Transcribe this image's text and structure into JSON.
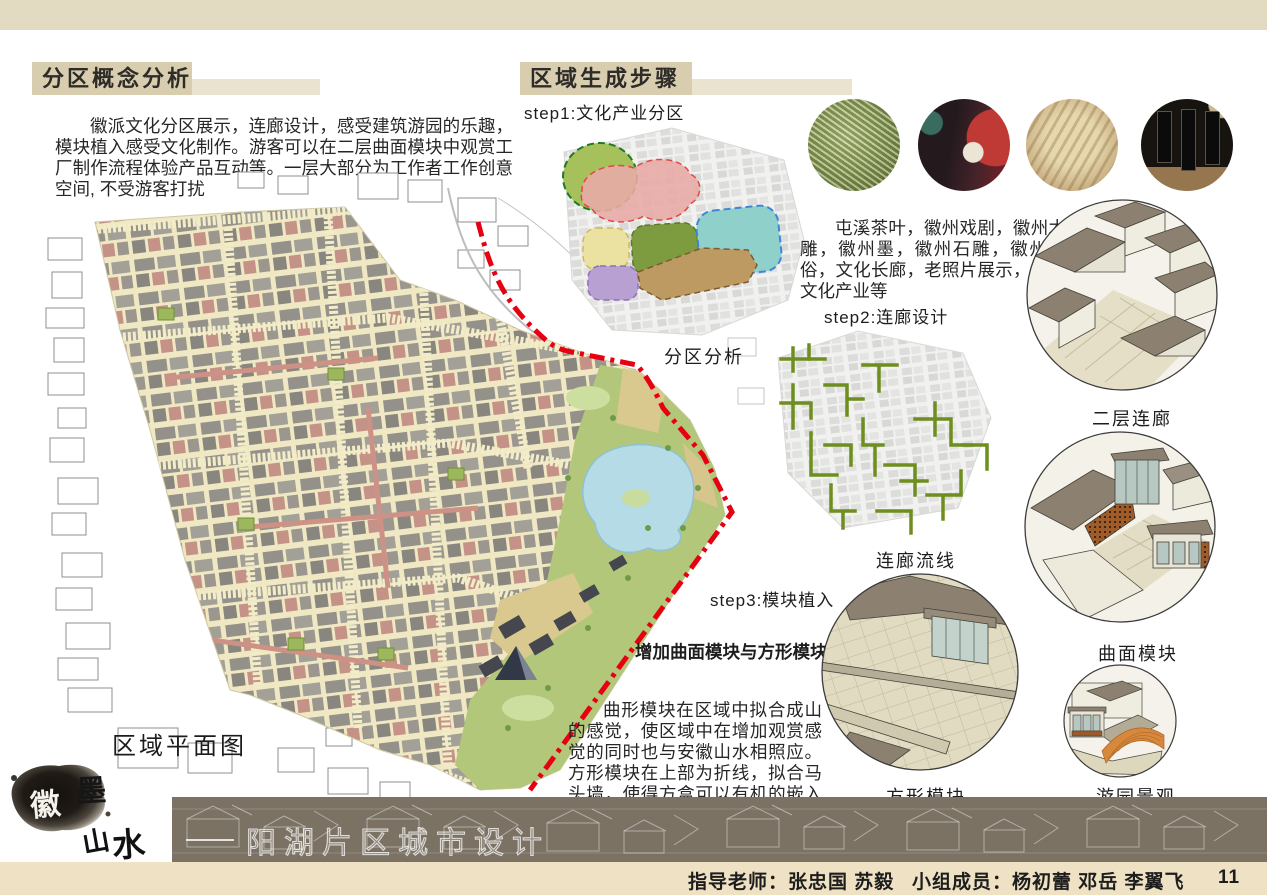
{
  "left_section": {
    "title": "分区概念分析",
    "intro": "徽派文化分区展示，连廊设计，感受建筑游园的乐趣，模块植入感受文化制作。游客可以在二层曲面模块中观赏工厂制作流程体验产品互动等。一层大部分为工作者工作创意空间, 不受游客打扰",
    "map_caption": "区域平面图"
  },
  "right_section": {
    "title": "区域生成步骤",
    "step1_label": "step1:文化产业分区",
    "step1_caption": "分区分析",
    "step1_description": "屯溪茶叶，徽州戏剧，徽州木雕，徽州墨，徽州石雕，徽州民俗，文化长廊，老照片展示，创意文化产业等",
    "step2_label": "step2:连廊设计",
    "step2_caption": "连廊流线",
    "step3_label": "step3:模块植入",
    "step3_subtitle": "增加曲面模块与方形模块",
    "step3_description": "曲形模块在区域中拟合成山的感觉，使区域中在增加观赏感觉的同时也与安徽山水相照应。方形模块在上部为折线，拟合马头墙，使得方盒可以有机的嵌入建筑中。",
    "photos": [
      {
        "name": "tunxi-tea-photo"
      },
      {
        "name": "huizhou-opera-photo"
      },
      {
        "name": "huizhou-woodcarving-photo"
      },
      {
        "name": "huizhou-ink-photo"
      }
    ],
    "render_captions": [
      "二层连廊",
      "曲面模块",
      "方形模块",
      "游园景观"
    ]
  },
  "footer": {
    "logo_chars": {
      "c1": "徽",
      "c2": "墨",
      "c3": "山",
      "c4": "水"
    },
    "banner_title": "阳湖片区城市设计",
    "credits_teacher": "指导老师：张忠国 苏毅",
    "credits_members": "小组成员：杨初蕾 邓岳 李翼飞",
    "page_number": "11"
  },
  "colors": {
    "top_band": "#e3dac2",
    "title_box": "#d9cdaf",
    "boundary_red": "#e60012",
    "corridor_green": "#6e8e20",
    "banner_bg": "#7b7264",
    "footer_strip": "#eee1c4"
  }
}
